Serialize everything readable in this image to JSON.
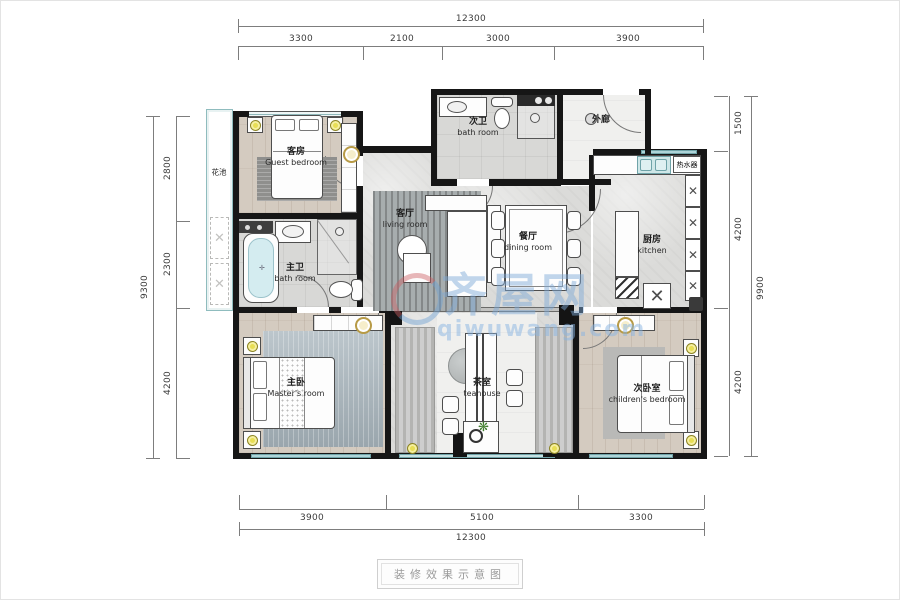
{
  "caption": {
    "text": "装修效果示意图"
  },
  "watermark": {
    "cn": "齐屋网",
    "url": "qiwuwang.com"
  },
  "dims": {
    "top_total": "12300",
    "top_segs": [
      "3300",
      "2100",
      "3000",
      "3900"
    ],
    "bottom_segs": [
      "3900",
      "5100",
      "3300"
    ],
    "bottom_total": "12300",
    "left_total": "9300",
    "left_segs": [
      "2800",
      "2300",
      "4200"
    ],
    "right_segs": [
      "1500",
      "4200",
      "4200"
    ],
    "right_total": "9900"
  },
  "rooms": {
    "guest": {
      "zh": "客房",
      "en": "Guest bedroom"
    },
    "bath2": {
      "zh": "次卫",
      "en": "bath room"
    },
    "corridor": {
      "zh": "外廊",
      "en": ""
    },
    "planter": {
      "zh": "花池",
      "en": ""
    },
    "living": {
      "zh": "客厅",
      "en": "living room"
    },
    "dining": {
      "zh": "餐厅",
      "en": "dining room"
    },
    "kitchen": {
      "zh": "厨房",
      "en": "kitchen"
    },
    "bath1": {
      "zh": "主卫",
      "en": "bath room"
    },
    "master": {
      "zh": "主卧",
      "en": "Master's room"
    },
    "tea": {
      "zh": "茶室",
      "en": "teahouse"
    },
    "children": {
      "zh": "次卧室",
      "en": "children's bedroom"
    },
    "heater": {
      "zh": "热水器",
      "en": ""
    }
  },
  "colors": {
    "wall": "#161616",
    "window_teal": "#aed4d8",
    "lamp_yellow": "#e8de55",
    "watermark_blue": "#7daad7",
    "wood_floor": "#d4cbc0",
    "marble_floor": "#dbdbd9"
  }
}
